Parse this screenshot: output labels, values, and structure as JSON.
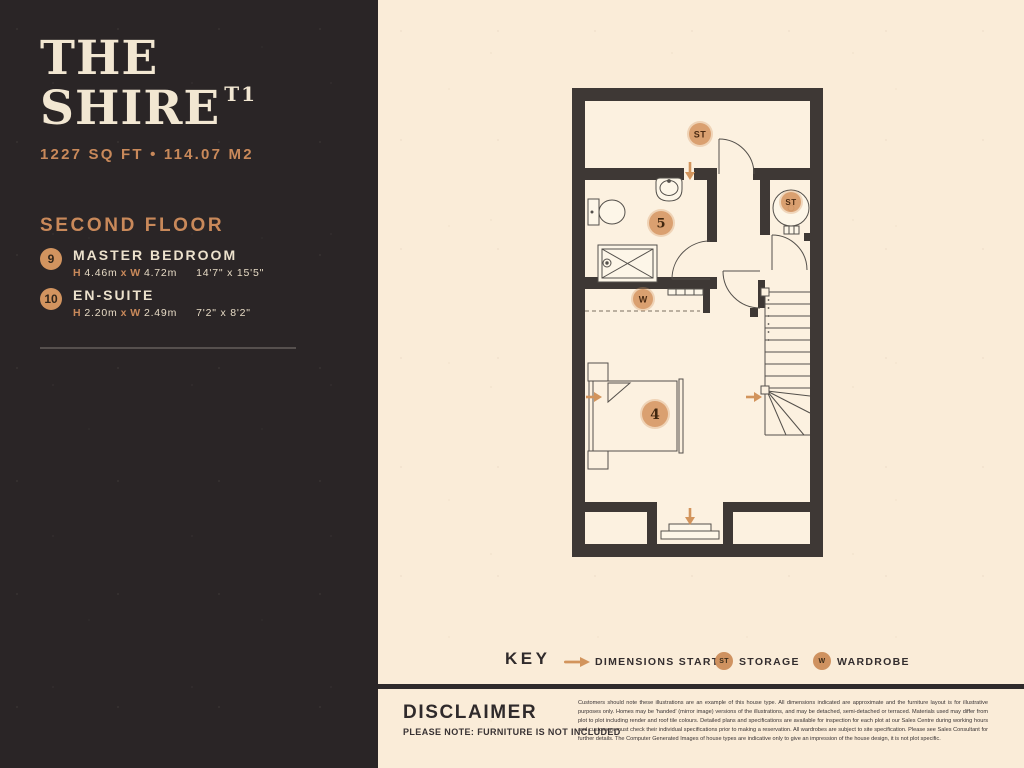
{
  "colors": {
    "panel_dark": "#2a2526",
    "cream": "#faecd8",
    "accent_orange": "#cf9260",
    "wall": "#3e3835"
  },
  "sidebar": {
    "title_line1": "THE",
    "title_line2": "SHIRE",
    "title_sup": "T1",
    "area": "1227 SQ FT  •  114.07 M2",
    "floor_heading": "SECOND FLOOR",
    "rooms": [
      {
        "number": "9",
        "name": "MASTER BEDROOM",
        "h_label": "H",
        "h_value": "4.46m",
        "x_label": "x",
        "w_label": "W",
        "w_value": "4.72m",
        "imperial": "14'7\" x 15'5\""
      },
      {
        "number": "10",
        "name": "EN-SUITE",
        "h_label": "H",
        "h_value": "2.20m",
        "x_label": "x",
        "w_label": "W",
        "w_value": "2.49m",
        "imperial": "7'2\" x 8'2\""
      }
    ]
  },
  "plan": {
    "markers": {
      "storage_top": "ST",
      "storage_right": "ST",
      "wardrobe": "W",
      "ensuite_number": "5",
      "bedroom_number": "4"
    }
  },
  "key": {
    "title": "KEY",
    "dimensions_label": "DIMENSIONS START",
    "storage_abbr": "ST",
    "storage_label": "STORAGE",
    "wardrobe_abbr": "W",
    "wardrobe_label": "WARDROBE"
  },
  "disclaimer": {
    "heading": "DISCLAIMER",
    "note": "PLEASE NOTE: FURNITURE IS NOT INCLUDED",
    "body": "Customers should note these illustrations are an example of this house type. All dimensions indicated are approximate and the furniture layout is for illustrative purposes only. Homes may be 'handed' (mirror image) versions of the illustrations, and may be detached, semi-detached or terraced. Materials used may differ from plot to plot including render and roof tile colours. Detailed plans and specifications are available for inspection for each plot at our Sales Centre during working hours and customers must check their individual specifications prior to making a reservation. All wardrobes are subject to site specification. Please see Sales Consultant for further details. The Computer Generated Images of house types are indicative only to give an impression of the house design, it is not plot specific."
  }
}
